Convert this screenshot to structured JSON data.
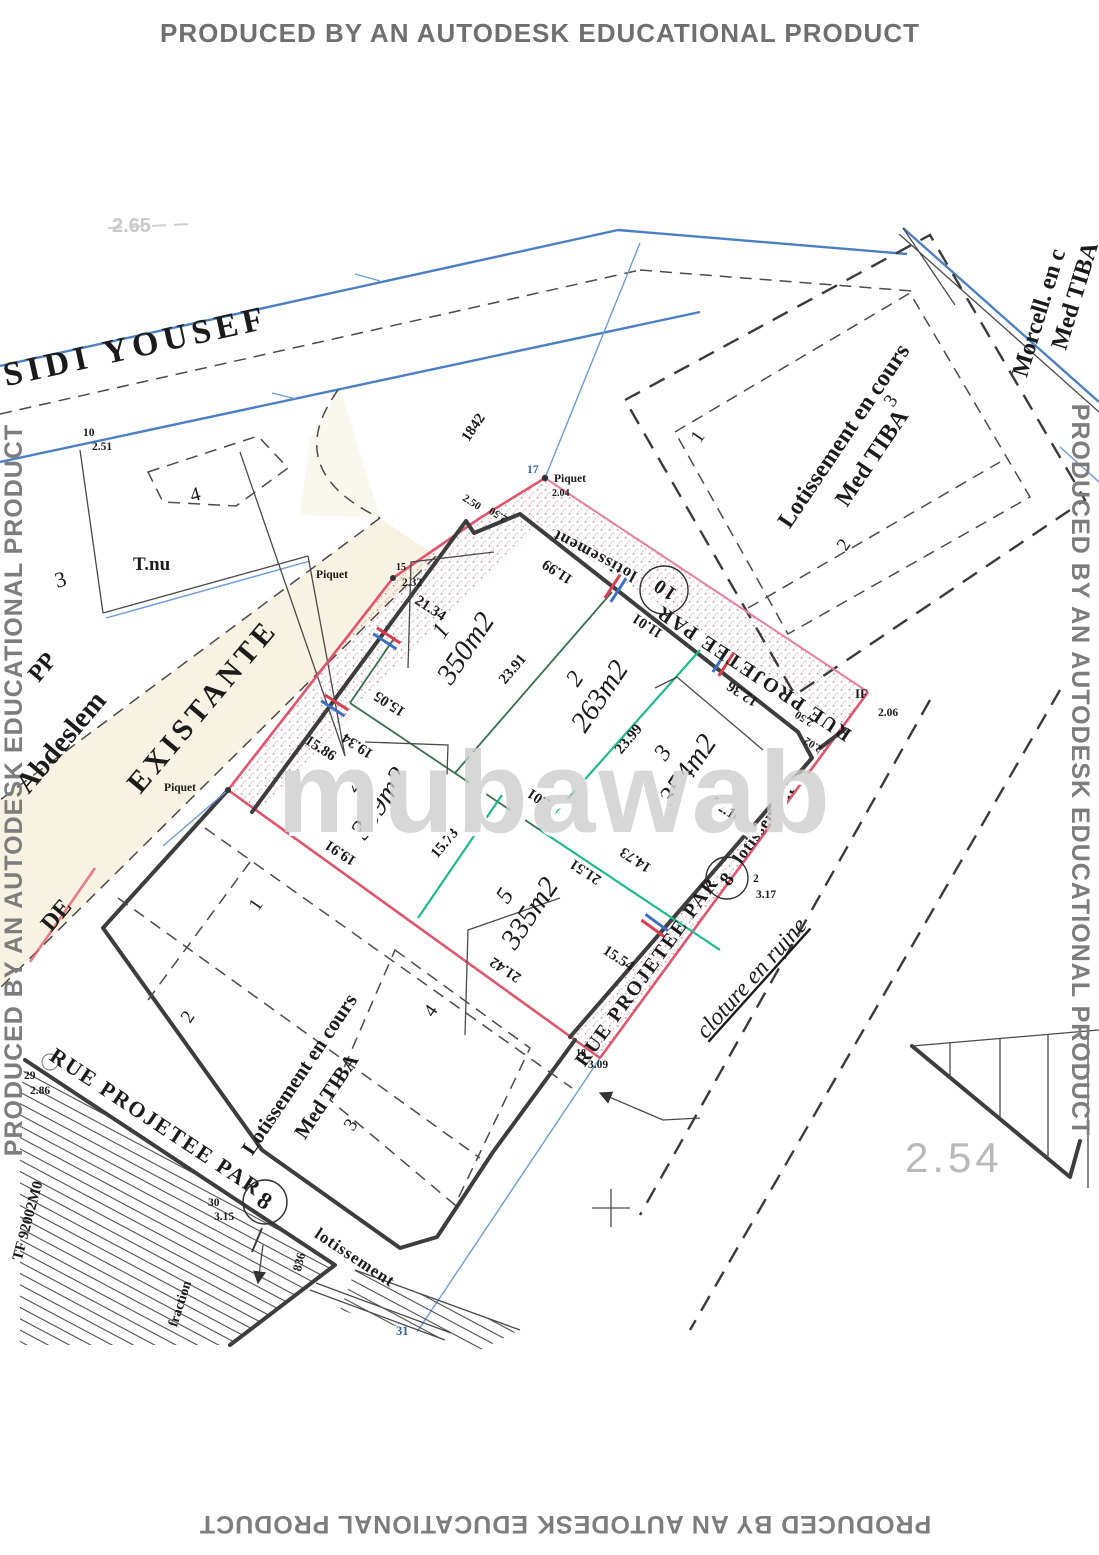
{
  "watermark": {
    "autodesk": "PRODUCED BY AN AUTODESK EDUCATIONAL PRODUCT",
    "brand": "mubawab"
  },
  "streets": {
    "sidi_yousef": "SIDI YOUSEF",
    "existante": "EXISTANTE",
    "de": "DE",
    "rue": "RUE PROJETEE PAR",
    "lotissement": "lotissement",
    "n8": "8",
    "n10": "10",
    "cloture": "cloture en ruine"
  },
  "north_block": {
    "l1": "Lotissement en cours",
    "l2": "Med TIBA",
    "p1": "1",
    "p2": "2",
    "p3": "3"
  },
  "south_block": {
    "l1": "Lotissement en cours",
    "l2": "Med TIBA",
    "p1": "1",
    "p2": "2",
    "p3": "3",
    "p4": "4"
  },
  "morcell": {
    "l1": "Morcell. en c",
    "l2": "Med TIBA"
  },
  "lots": [
    {
      "n": "1",
      "a": "350m2"
    },
    {
      "n": "2",
      "a": "263m2"
    },
    {
      "n": "3",
      "a": "354m2"
    },
    {
      "n": "4",
      "a": "309m2"
    },
    {
      "n": "5",
      "a": "335m2"
    }
  ],
  "dims": {
    "nw1": "21.34",
    "nw2": "15.86",
    "ne1": "11.99",
    "ne2": "11.01",
    "ne3": "12.36",
    "d1": "23.91",
    "d2": "23.99",
    "d3": "15.05",
    "d4": "19.34",
    "mid": "11.01",
    "d5": "15.73",
    "sw1": "19.91",
    "sw2": "21.42",
    "in1": "21.51",
    "in2": "14.73",
    "se1": "22.10",
    "se2": "15.54",
    "tie": "1842",
    "j1": "2.50",
    "j2": "2.50",
    "j3": "2.50",
    "j4": "2.02"
  },
  "points": {
    "p10n": "10",
    "p10v": "2.51",
    "p15l": "Piquet",
    "p15n": "15",
    "p15v": "2.32",
    "p17n": "17",
    "p17l": "Piquet",
    "p17v": "2.04",
    "pwl": "Piquet",
    "ifn": "IF",
    "ifv": "2.06",
    "p2n": "2",
    "p2v": "3.17",
    "p18n": "18",
    "p18v": "3.09",
    "p29n": "29",
    "p29v": "2.86",
    "p30n": "30",
    "p30v": "3.15",
    "p31": "31",
    "c836": "836"
  },
  "labels": {
    "tnu": "T.nu",
    "pp": "PP",
    "abdeslem": "Abdeslem",
    "n3": "3",
    "n4": "4",
    "tf": "TF 92002M0",
    "fraction": "fraction",
    "elev": "2.54",
    "faint": "2.65"
  }
}
